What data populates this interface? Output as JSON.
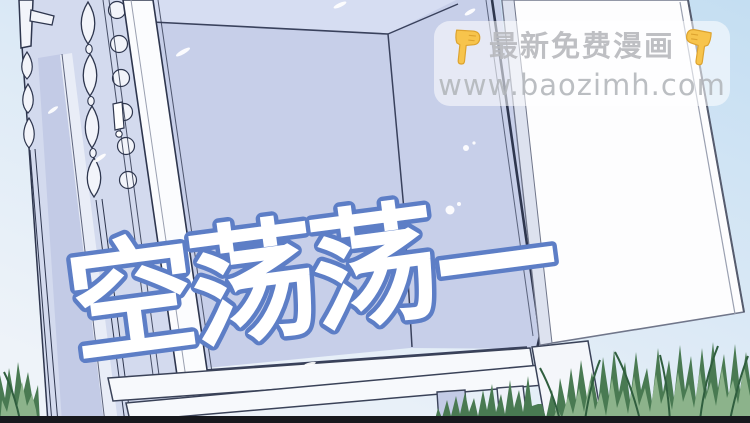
{
  "caption": {
    "text": "空荡荡—",
    "fill": "#ffffff",
    "outline": "#5d7ec6"
  },
  "watermark": {
    "line1": "最新免费漫画",
    "line2": "www.baozimh.com",
    "left_icon": "backhand-index-pointing-down",
    "right_icon": "backhand-index-pointing-down",
    "text_color": "#bababd",
    "box_color": "rgba(255,255,255,0.55)",
    "finger_color": "#f7c44c"
  },
  "colors": {
    "sky_top": "#c4def2",
    "sky_bottom": "#ecf2f9",
    "wardrobe_interior": "#c7cfe9",
    "wardrobe_ceiling": "#d6ddf2",
    "carved_frame": "#d3daee",
    "door": "#fdfdfe",
    "line_art": "#2e364e",
    "grass_dark": "#497a52",
    "grass_light": "#8cb38b",
    "bottom_bar": "#17181d"
  }
}
